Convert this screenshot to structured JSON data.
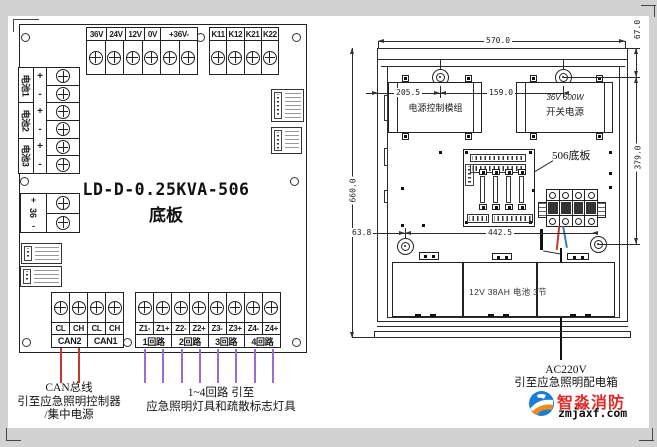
{
  "left_board": {
    "title": "LD-D-0.25KVA-506",
    "subtitle": "底板",
    "top_a": [
      "36V",
      "24V",
      "12V",
      "0V",
      "+36V-"
    ],
    "top_b": [
      "K11",
      "K12",
      "K21",
      "K22"
    ],
    "batteries": [
      "电池1",
      "电池2",
      "电池3"
    ],
    "battery_signs": [
      "+",
      "-",
      "+",
      "-",
      "+",
      "-"
    ],
    "out36": [
      "+",
      "36",
      "-"
    ],
    "can_row1": [
      "CL",
      "CH",
      "CL",
      "CH"
    ],
    "can_row2": [
      "CAN2",
      "CAN1"
    ],
    "z_row1": [
      "Z1-",
      "Z1+",
      "Z2-",
      "Z2+",
      "Z3-",
      "Z3+",
      "Z4-",
      "Z4+"
    ],
    "z_row2": [
      "1回路",
      "2回路",
      "3回路",
      "4回路"
    ]
  },
  "annotations": {
    "can_1": "CAN总线",
    "can_2": "引至应急照明控制器",
    "can_3": "/集中电源",
    "circ_1": "1~4回路  引至",
    "circ_2": "应急照明灯具和疏散标志灯具",
    "ac_1": "AC220V",
    "ac_2": "引至应急照明配电箱",
    "pcb": "506底板"
  },
  "enclosure": {
    "module_left": "电源控制模组",
    "module_right_1": "36V 600W",
    "module_right_2": "开关电源",
    "battery_label": "12V 38AH 电池 3节",
    "dims": {
      "width": "570.0",
      "height": "660.0",
      "top_offset": "67.0",
      "panel_height": "379.0",
      "d205": "205.5",
      "d159": "159.0",
      "d63": "63.8",
      "d442": "442.5"
    }
  },
  "logo": {
    "brand": "智淼消防",
    "site": "zmjaxf.com"
  },
  "colors": {
    "wire_red": "#c0392b",
    "wire_purple": "#9b6bd3",
    "wire_blue": "#3a7abf",
    "logo_red": "#e02b2b",
    "logo_blue": "#1a7fd4",
    "logo_orange": "#f08c1a"
  }
}
